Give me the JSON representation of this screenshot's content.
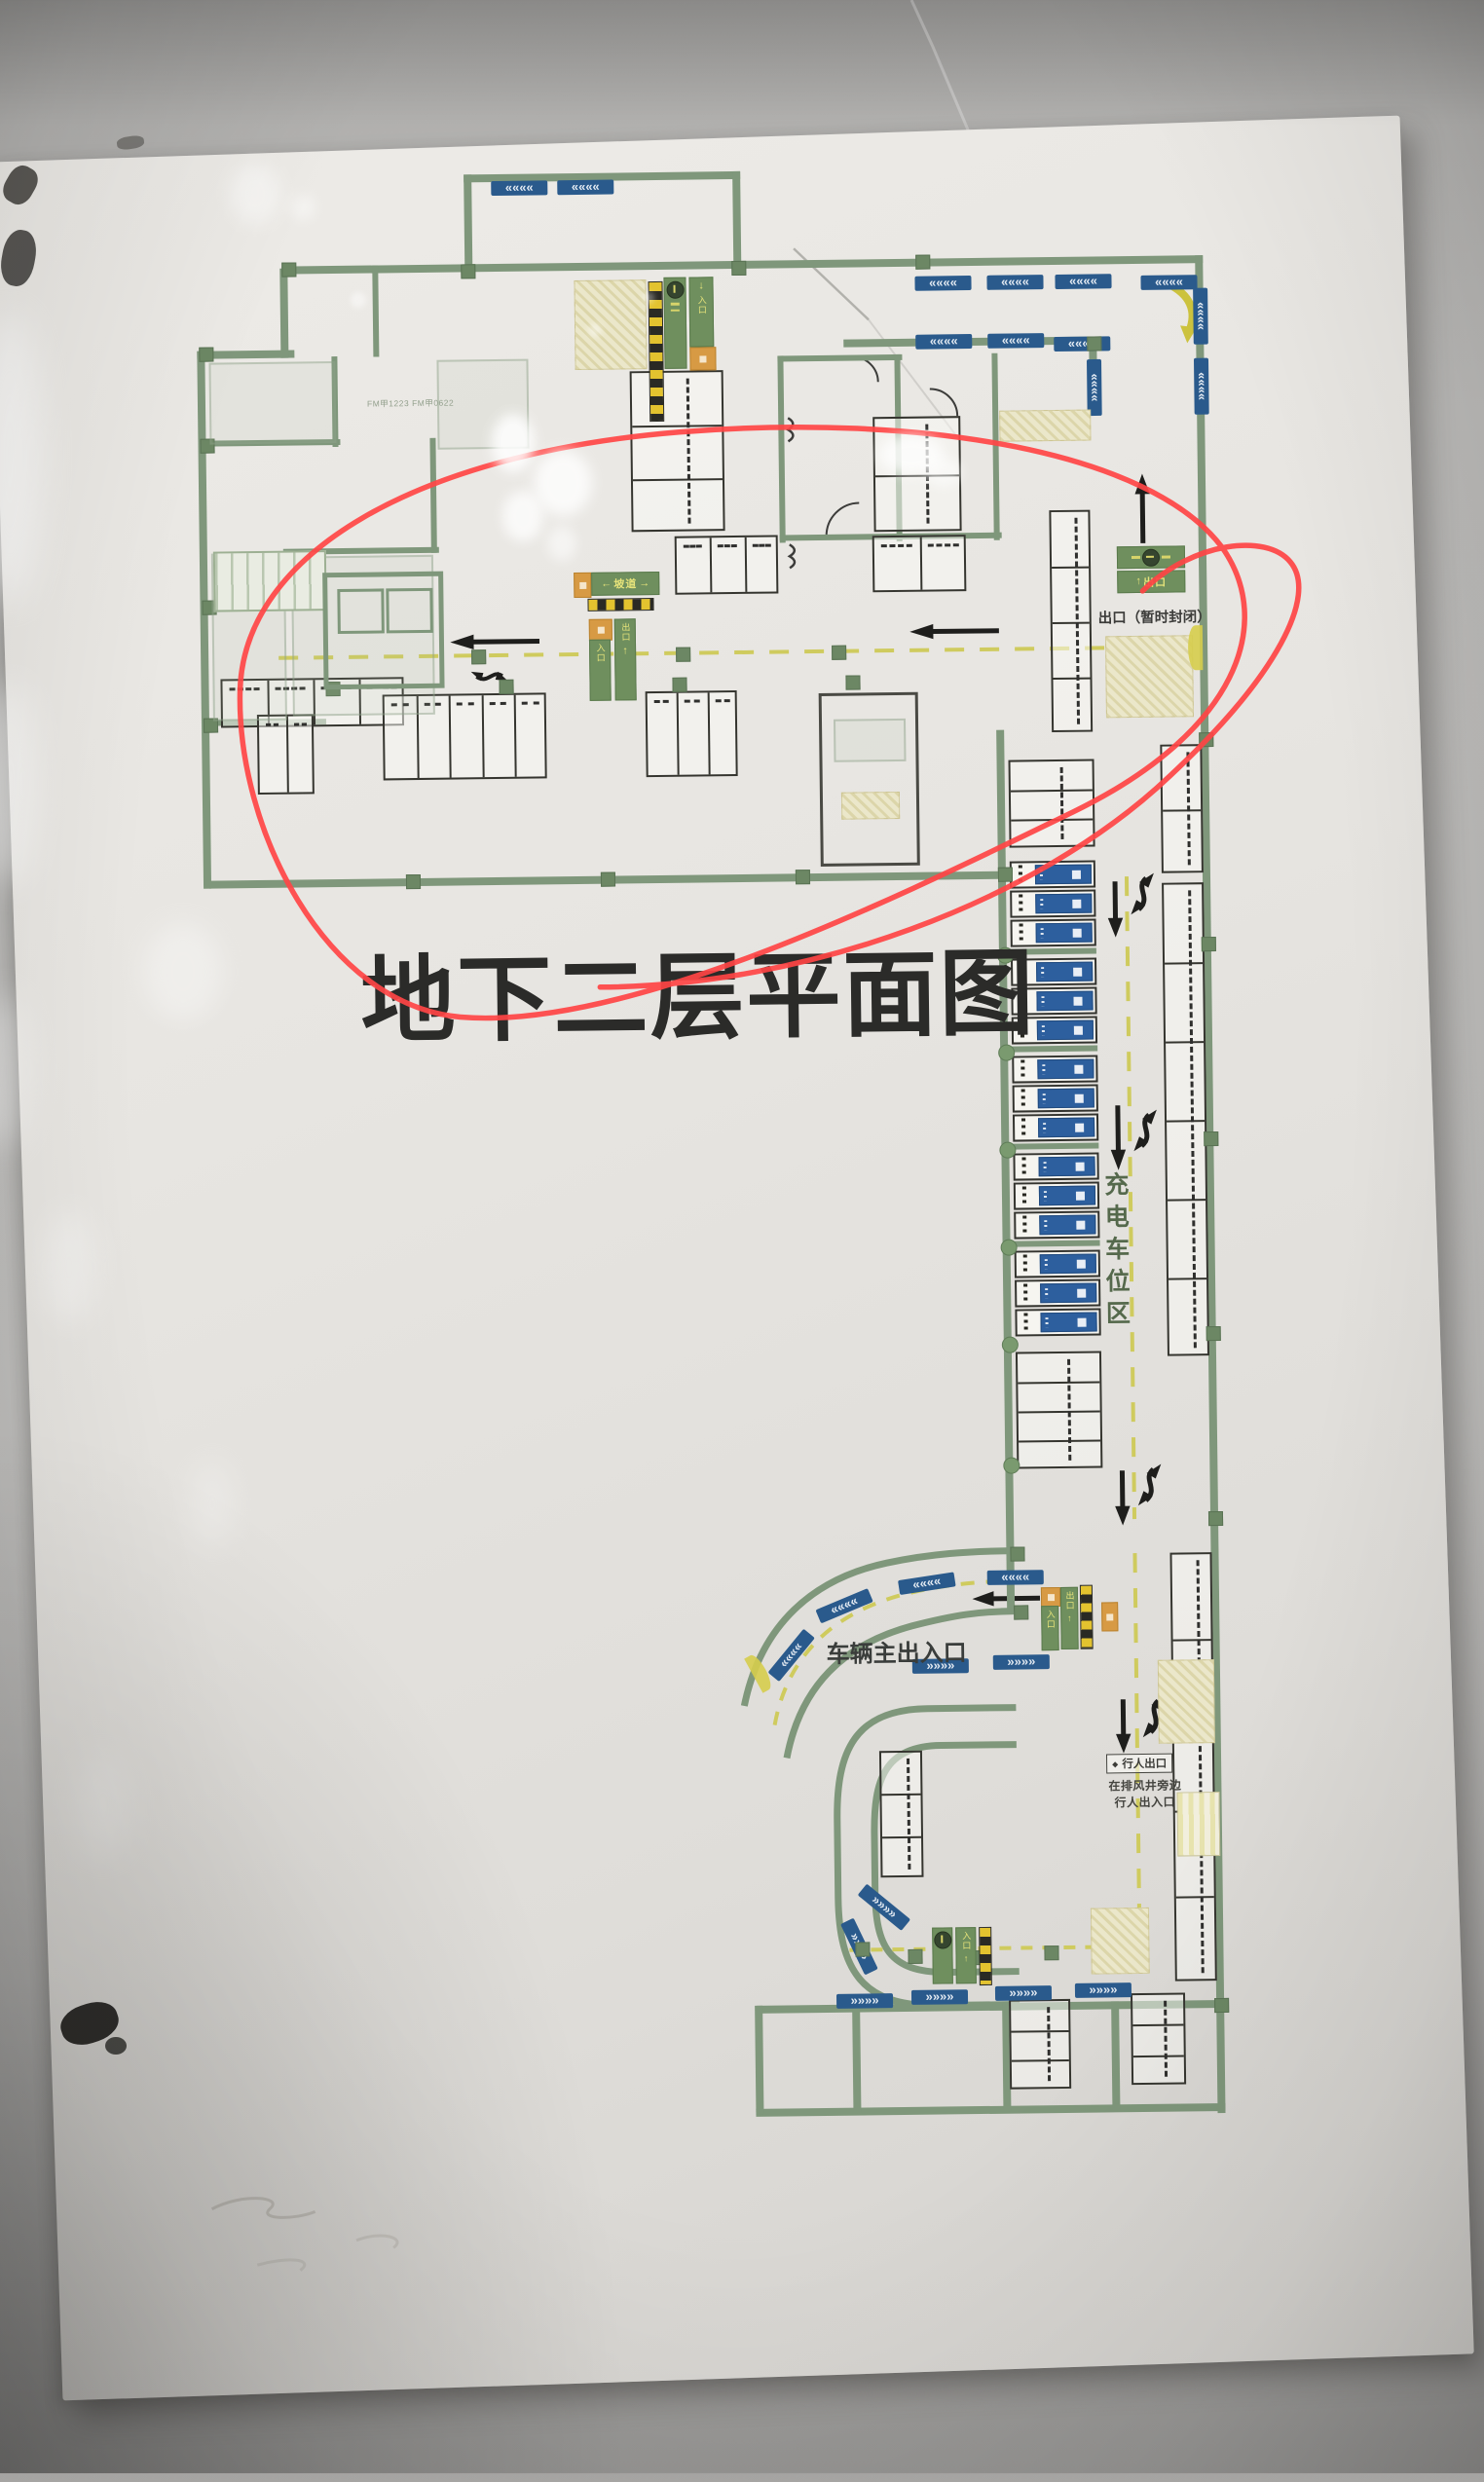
{
  "plan": {
    "title": "地下二层平面图",
    "labels": {
      "exit_closed": "出口（暂时封闭）",
      "charging_zone": "充电车位区",
      "vehicle_entrance": "车辆主出入口",
      "pedestrian_exit": "行人出口",
      "pedestrian_note_line1": "在排风井旁边",
      "pedestrian_note_line2": "行人出入口",
      "room_code": "FM甲1223  FM甲0622"
    },
    "signs": {
      "ramp": "坡道",
      "entrance": "入口",
      "exit": "出口"
    },
    "icons": {
      "up_arrow": "↑",
      "down_arrow": "↓",
      "left_arrow": "←",
      "right_arrow": "→",
      "bullet": "◆",
      "chevron_left": "««««",
      "chevron_right": "»»»»"
    },
    "colors": {
      "wall_green": "#7f977b",
      "charging_blue": "#2d5f9e",
      "chevron_blue": "#2a5a8c",
      "lane_yellow": "#cfcb5e",
      "sign_green": "#6f8f5e",
      "sign_orange": "#d79a44",
      "highlight_red": "#ff4545"
    }
  }
}
